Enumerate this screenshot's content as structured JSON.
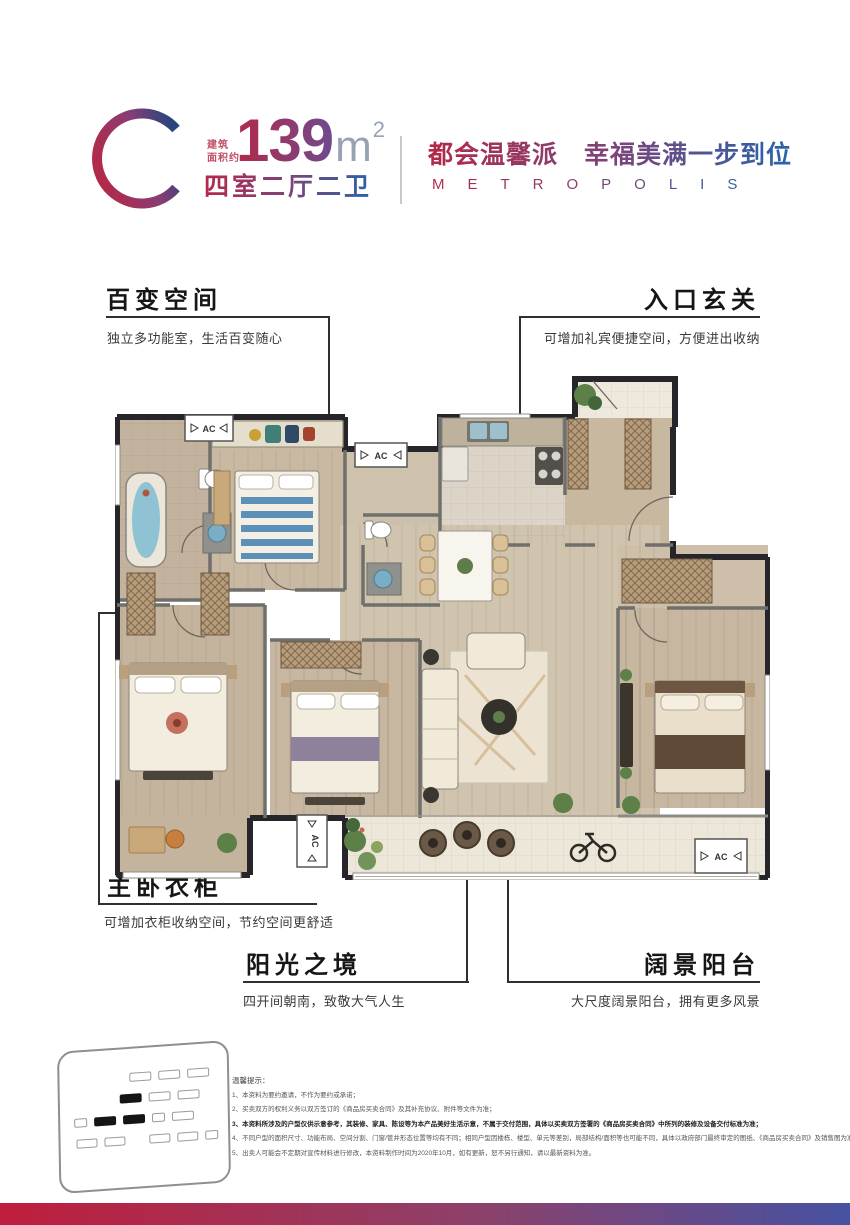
{
  "header": {
    "unit_letter": "C",
    "area_prefix_line1": "建筑",
    "area_prefix_line2": "面积约",
    "area_value": "139",
    "area_unit": "m",
    "area_exponent": "2",
    "layout_spec": "四室二厅二卫",
    "slogan_cn": "都会温馨派　幸福美满一步到位",
    "slogan_en": "METROPOLIS"
  },
  "callouts": [
    {
      "title": "百变空间",
      "subtitle": "独立多功能室，生活百变随心"
    },
    {
      "title": "入口玄关",
      "subtitle": "可增加礼宾便捷空间，方便进出收纳"
    },
    {
      "title": "主卧衣柜",
      "subtitle": "可增加衣柜收纳空间，节约空间更舒适"
    },
    {
      "title": "阳光之境",
      "subtitle": "四开间朝南，致敬大气人生"
    },
    {
      "title": "阔景阳台",
      "subtitle": "大尺度阔景阳台，拥有更多风景"
    }
  ],
  "floor_plan": {
    "ac_label": "AC"
  },
  "site_plan": {
    "rows": [
      {
        "indent": 60,
        "items": [
          "o",
          "o",
          "o"
        ]
      },
      {
        "indent": 50,
        "items": [
          "f",
          "o",
          "o"
        ]
      },
      {
        "indent": 4,
        "items": [
          "s",
          "f",
          "f",
          "s",
          "o"
        ]
      },
      {
        "indent": 6,
        "items": [
          "o",
          "o",
          "g",
          "o",
          "o",
          "s"
        ]
      }
    ]
  },
  "disclaimer": {
    "title": "温馨提示：",
    "lines": [
      "1、本资料为要约邀请，不作为要约或承诺；",
      "2、买卖双方的权利义务以双方签订的《商品房买卖合同》及其补充协议、附件等文件为准；",
      "3、本资料所涉及的户型仅供示意参考，其装修、家具、陈设等为本产品美好生活示意，不属于交付范围，具体以买卖双方签署的《商品房买卖合同》中所列的装修及设备交付标准为准；",
      "4、不同户型的面积尺寸、功能布局、空间分割、门窗/管井形态位置等均有不同；相同户型因楼栋、楼型、单元等差别，局部结构/面积等也可能不同，具体以政府部门最终审定的图纸、《商品房买卖合同》及销售图为准；",
      "5、出卖人可能会不定期对宣传材料进行修改，本资料制作时间为2020年10月，如有更新，恕不另行通知，请以最新资料为准。"
    ]
  },
  "colors": {
    "brand_red": "#b3294b",
    "brand_blue": "#2e5fa3",
    "bar_gradient_left": "#bf1e3c",
    "bar_gradient_mid": "#8e4069",
    "bar_gradient_right": "#4652a2"
  }
}
